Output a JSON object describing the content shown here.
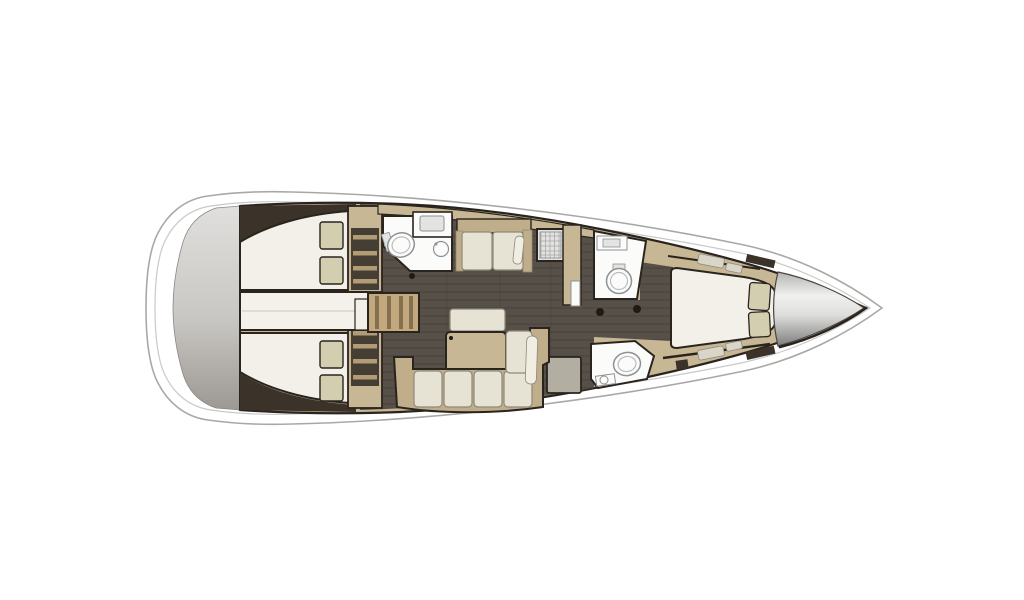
{
  "meta": {
    "width": 1024,
    "height": 600,
    "background": "#ffffff",
    "subject": "sailing-yacht-interior-floorplan-top-view-bow-right"
  },
  "palette": {
    "outline": "#2a241e",
    "hull_fill": "#ffffff",
    "hull_stroke": "#a8a8a6",
    "toerail_stroke": "#c9c9c7",
    "wood": "#c7b795",
    "settee_back": "#bfae89",
    "stair_wood": "#c2a87c",
    "stair_slat": "#84704e",
    "floor": "#575049",
    "plank": "rgba(30,25,20,0.25)",
    "wedge": "#3b332a",
    "locker_dark": "#453e34",
    "locker_stripe": "#b29c76",
    "bed": "#f2f0e9",
    "pillow": "#d4ceb1",
    "white_room": "#fbfbf9",
    "fixture_stroke": "#8e9296",
    "fixture_inner": "#b9bdc1",
    "fixture_light": "#e3e3e1",
    "cushion": "#e7e3d4",
    "cushion_stroke": "#8f897c",
    "blanket": "#f0ede3",
    "bench_gray": "#b2aea2",
    "grid_stroke": "#a8a8a6",
    "transom_light": "#e0dfdd",
    "transom_mid": "#c9c7c3",
    "transom_dark": "#9c9893",
    "transom_stroke": "#8a8784",
    "cone_dark_top": "#b4b4b2",
    "cone_light": "#f0f0ee",
    "cone_mid": "#dededc",
    "cone_dark": "#7e7e7c",
    "cone_stroke": "#4a453f",
    "hatch_light": "#d9d5c9",
    "hatch_stroke": "#8f8a80",
    "dot": "#1e1a15",
    "corridor": "#f3f1ea",
    "seam": "#d8d5cd"
  }
}
